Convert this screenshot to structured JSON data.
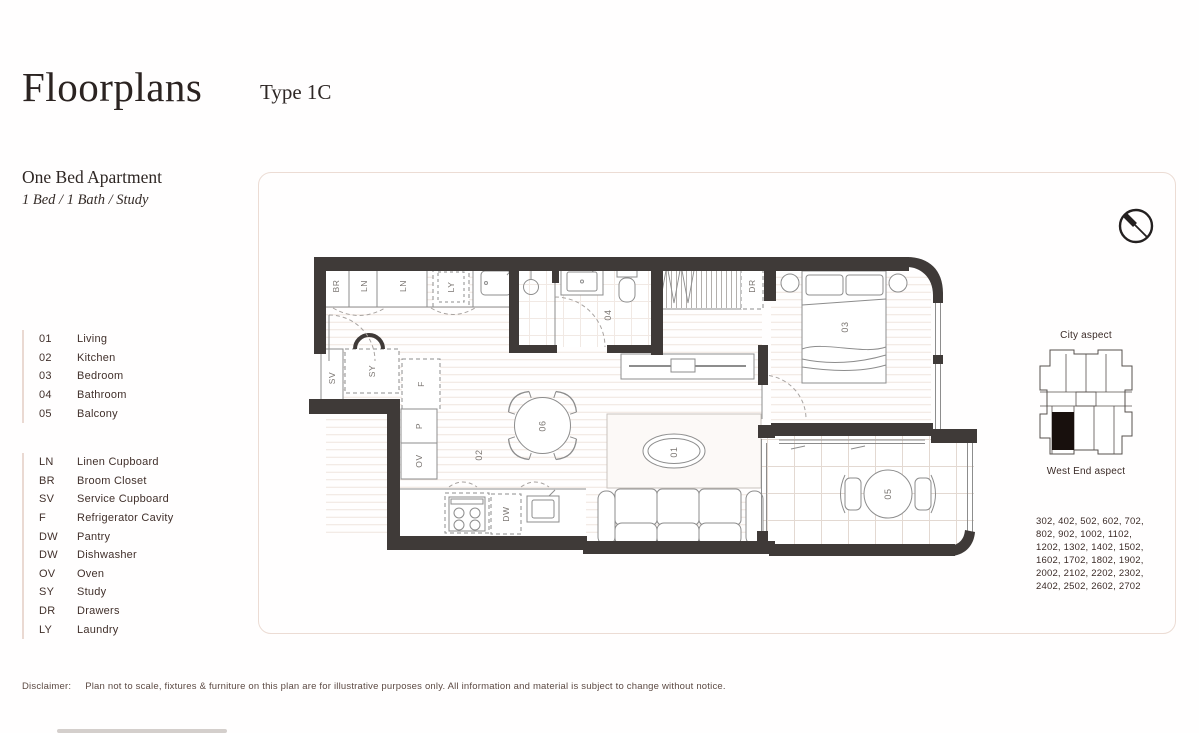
{
  "header": {
    "title": "Floorplans",
    "type": "Type 1C"
  },
  "apartment": {
    "name": "One Bed Apartment",
    "spec": "1 Bed / 1 Bath / Study"
  },
  "legend_rooms": {
    "items": [
      {
        "code": "01",
        "label": "Living"
      },
      {
        "code": "02",
        "label": "Kitchen"
      },
      {
        "code": "03",
        "label": "Bedroom"
      },
      {
        "code": "04",
        "label": "Bathroom"
      },
      {
        "code": "05",
        "label": "Balcony"
      }
    ]
  },
  "legend_fixtures": {
    "items": [
      {
        "code": "LN",
        "label": "Linen Cupboard"
      },
      {
        "code": "BR",
        "label": "Broom Closet"
      },
      {
        "code": "SV",
        "label": "Service Cupboard"
      },
      {
        "code": "F",
        "label": "Refrigerator Cavity"
      },
      {
        "code": "DW",
        "label": "Pantry"
      },
      {
        "code": "DW",
        "label": "Dishwasher"
      },
      {
        "code": "OV",
        "label": "Oven"
      },
      {
        "code": "SY",
        "label": "Study"
      },
      {
        "code": "DR",
        "label": "Drawers"
      },
      {
        "code": "LY",
        "label": "Laundry"
      }
    ]
  },
  "plan": {
    "labels": {
      "broom": "BR",
      "linen": "LN",
      "laundry": "LY",
      "service": "SV",
      "study": "SY",
      "fridge": "F",
      "pantry": "P",
      "oven": "OV",
      "dishwasher": "DW",
      "drawers": "DR",
      "living": "01",
      "kitchen": "02",
      "bedroom": "03",
      "bathroom": "04",
      "balcony": "05",
      "dining": "06"
    }
  },
  "aspect": {
    "top": "City aspect",
    "bottom": "West End aspect",
    "units": "302, 402, 502, 602, 702, 802, 902, 1002, 1102, 1202, 1302, 1402, 1502, 1602, 1702, 1802, 1902, 2002, 2102, 2202, 2302, 2402, 2502, 2602, 2702"
  },
  "disclaimer": {
    "label": "Disclaimer:",
    "text": "Plan not to scale, fixtures & furniture on this plan are for illustrative purposes only. All information and material is subject to change without notice."
  },
  "icons": {
    "compass": "north-arrow"
  },
  "colors": {
    "wall": "#3f3a38",
    "border": "#ecdcd4",
    "text": "#41302b",
    "title": "#2b2321",
    "line": "#8d8d8d",
    "highlight": "#18100d"
  }
}
